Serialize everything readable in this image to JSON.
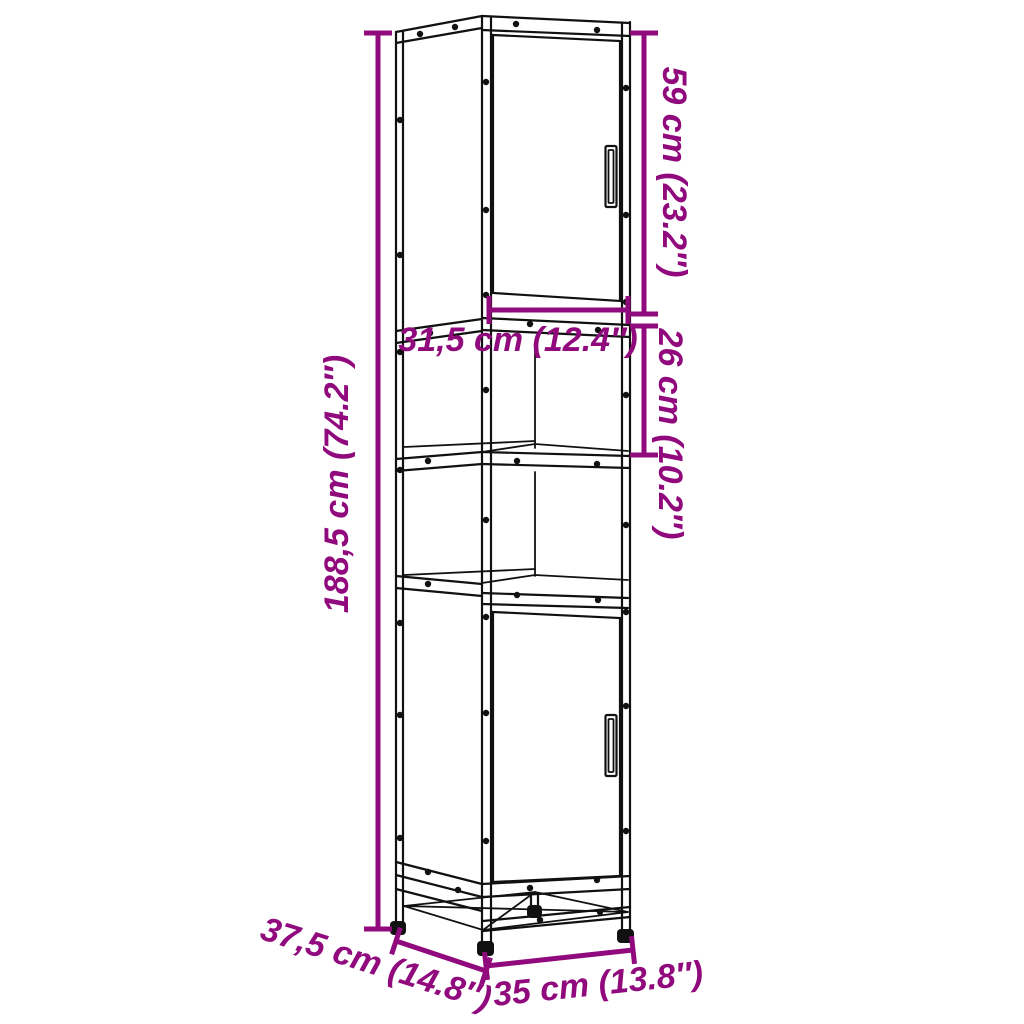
{
  "diagram": {
    "kind": "furniture-dimension-diagram",
    "subject": "tall bathroom cabinet with two doors, two open shelves and metal base frame",
    "background": "#ffffff",
    "accent_color": "#910A7D",
    "line_color": "#111111",
    "labels": {
      "overall_height": "188,5 cm (74.2″)",
      "top_door_height": "59 cm (23.2″)",
      "open_shelf_height": "26 cm (10.2″)",
      "inner_width": "31,5 cm (12.4″)",
      "depth": "37,5 cm (14.8″)",
      "width": "35 cm (13.8″)"
    }
  }
}
